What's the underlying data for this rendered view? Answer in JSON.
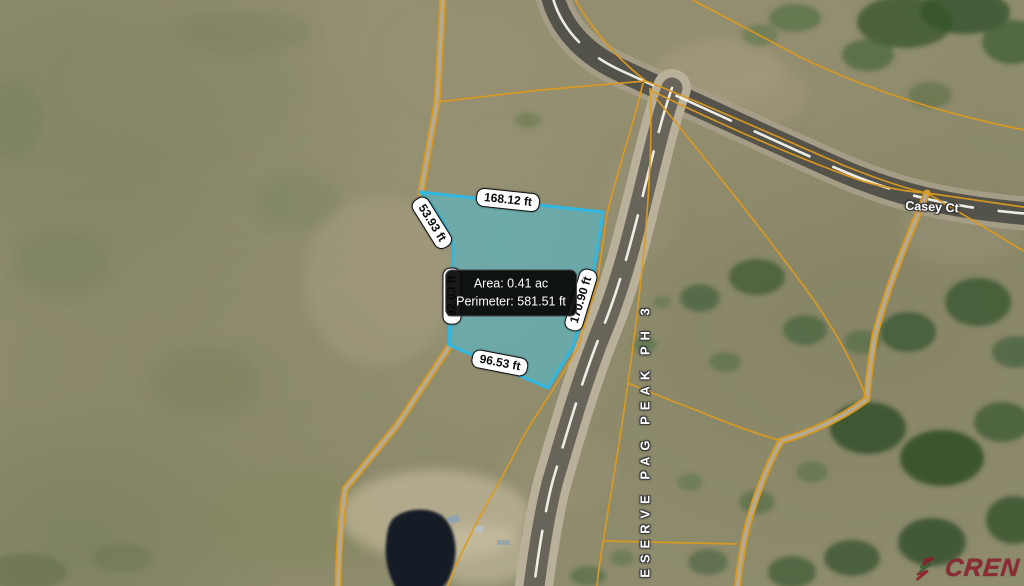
{
  "map": {
    "parcel": {
      "tooltip": {
        "area": "Area: 0.41 ac",
        "perimeter": "Perimeter: 581.51 ft"
      },
      "measurements": [
        {
          "side": "top",
          "text": "168.12 ft"
        },
        {
          "side": "upper-left",
          "text": "53.93 ft"
        },
        {
          "side": "left",
          "text": "92.03 ft"
        },
        {
          "side": "bottom",
          "text": "96.53 ft"
        },
        {
          "side": "right",
          "text": "170.90 ft"
        }
      ],
      "area_acres": 0.41,
      "perimeter_feet": 581.51
    },
    "road_labels": {
      "casey": "Casey Ct",
      "vertical": "ESERVE PAG PEAK PH 3"
    },
    "watermark": "CREN",
    "colors": {
      "parcel_fill": "#4dbfd6",
      "parcel_stroke": "#31b8e2",
      "boundary_line": "#dd9a1e",
      "watermark_red": "#8c1e2c"
    }
  }
}
